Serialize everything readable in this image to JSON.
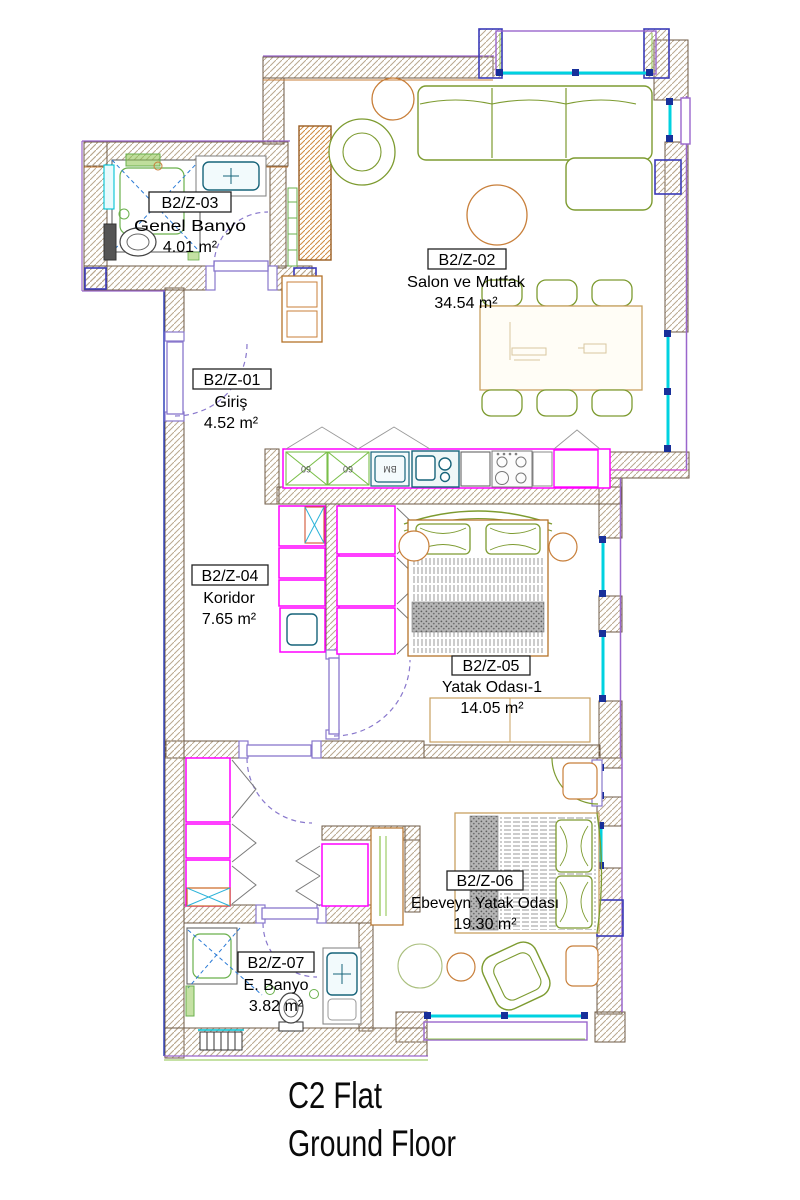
{
  "drawing": {
    "title_line1": "C2 Flat",
    "title_line2": "Ground Floor"
  },
  "rooms": [
    {
      "code": "B2/Z-01",
      "name": "Giriş",
      "area": "4.52 m²"
    },
    {
      "code": "B2/Z-02",
      "name": "Salon ve Mutfak",
      "area": "34.54 m²"
    },
    {
      "code": "B2/Z-03",
      "name": "Genel Banyo",
      "area": "4.01 m²"
    },
    {
      "code": "B2/Z-04",
      "name": "Koridor",
      "area": "7.65 m²"
    },
    {
      "code": "B2/Z-05",
      "name": "Yatak Odası-1",
      "area": "14.05 m²"
    },
    {
      "code": "B2/Z-06",
      "name": "Ebeveyn Yatak Odası",
      "area": "19.30 m²"
    },
    {
      "code": "B2/Z-07",
      "name": "E. Banyo",
      "area": "3.82 m²"
    }
  ],
  "kitchen": {
    "cabinet_labels": [
      "60",
      "60"
    ],
    "appliance_label": "BM"
  },
  "colors": {
    "wall_hatch": "#b9a88f",
    "wall_edge": "#6e5a45",
    "furniture_green": "#7d9b30",
    "wood_orange": "#c87f3a",
    "cabinet_magenta": "#ff00ff",
    "window_cyan": "#00d2e0",
    "door_violet": "#8877cc",
    "column_blue": "#3a3ab8",
    "fixture_teal": "#1f7f8f",
    "tick_blue": "#18309a",
    "text": "#000000"
  }
}
